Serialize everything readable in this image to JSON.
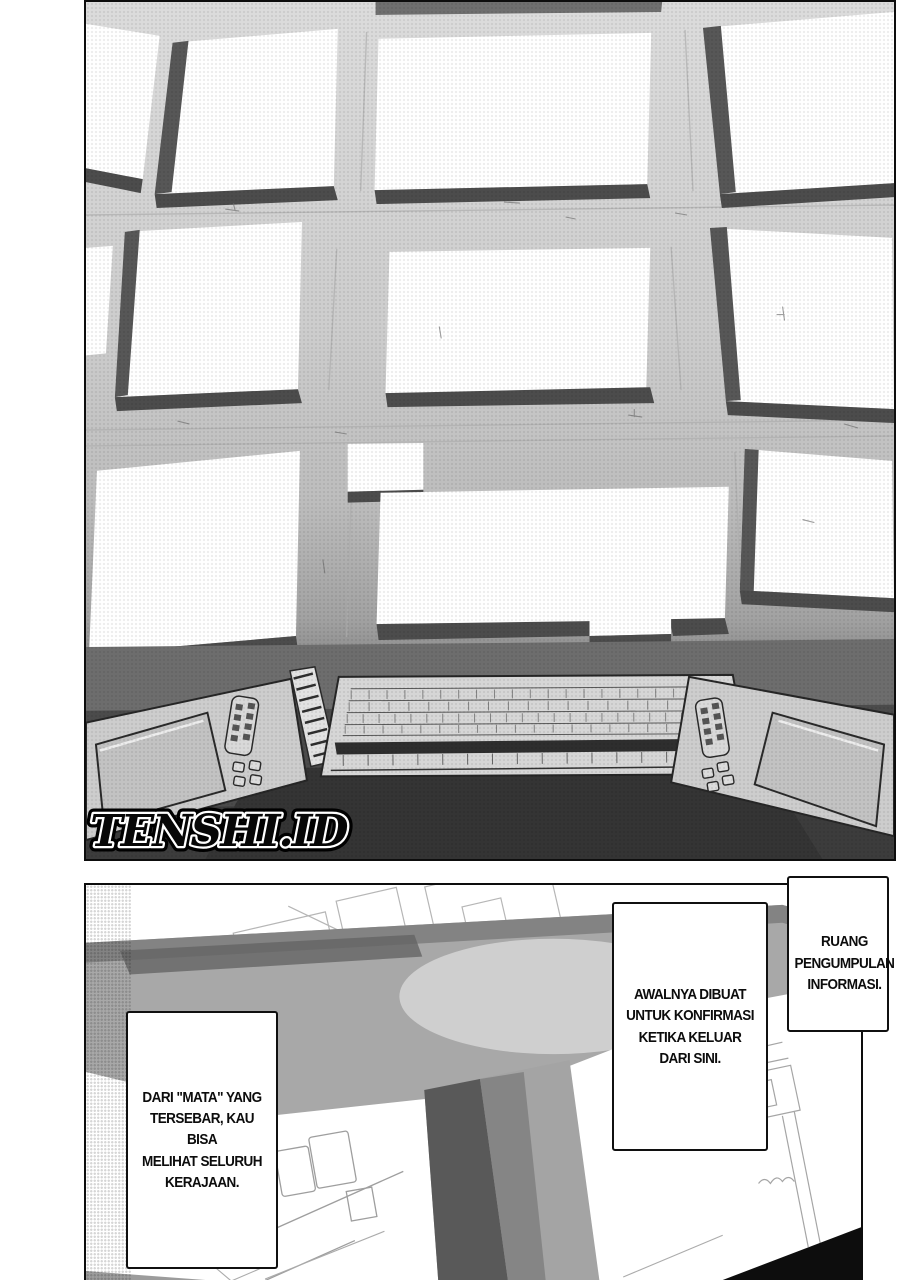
{
  "watermark": {
    "text": "TENSHI.ID"
  },
  "dialogue": {
    "info_room": {
      "text": "RUANG\nPENGUMPULAN\nINFORMASI."
    },
    "purpose": {
      "text": "AWALNYA DIBUAT\nUNTUK KONFIRMASI\nKETIKA KELUAR\nDARI SINI."
    },
    "eyes": {
      "text": "DARI \"MATA\" YANG\nTERSEBAR, KAU BISA\nMELIHAT SELURUH\nKERAJAAN."
    }
  },
  "colors": {
    "ink": "#0d0d0d",
    "wall_light": "#dcdcdc",
    "screen_shadow": "#4c4c4c",
    "floor_dark": "#4b4b4b",
    "corridor_gray": "#a8a8a8"
  }
}
